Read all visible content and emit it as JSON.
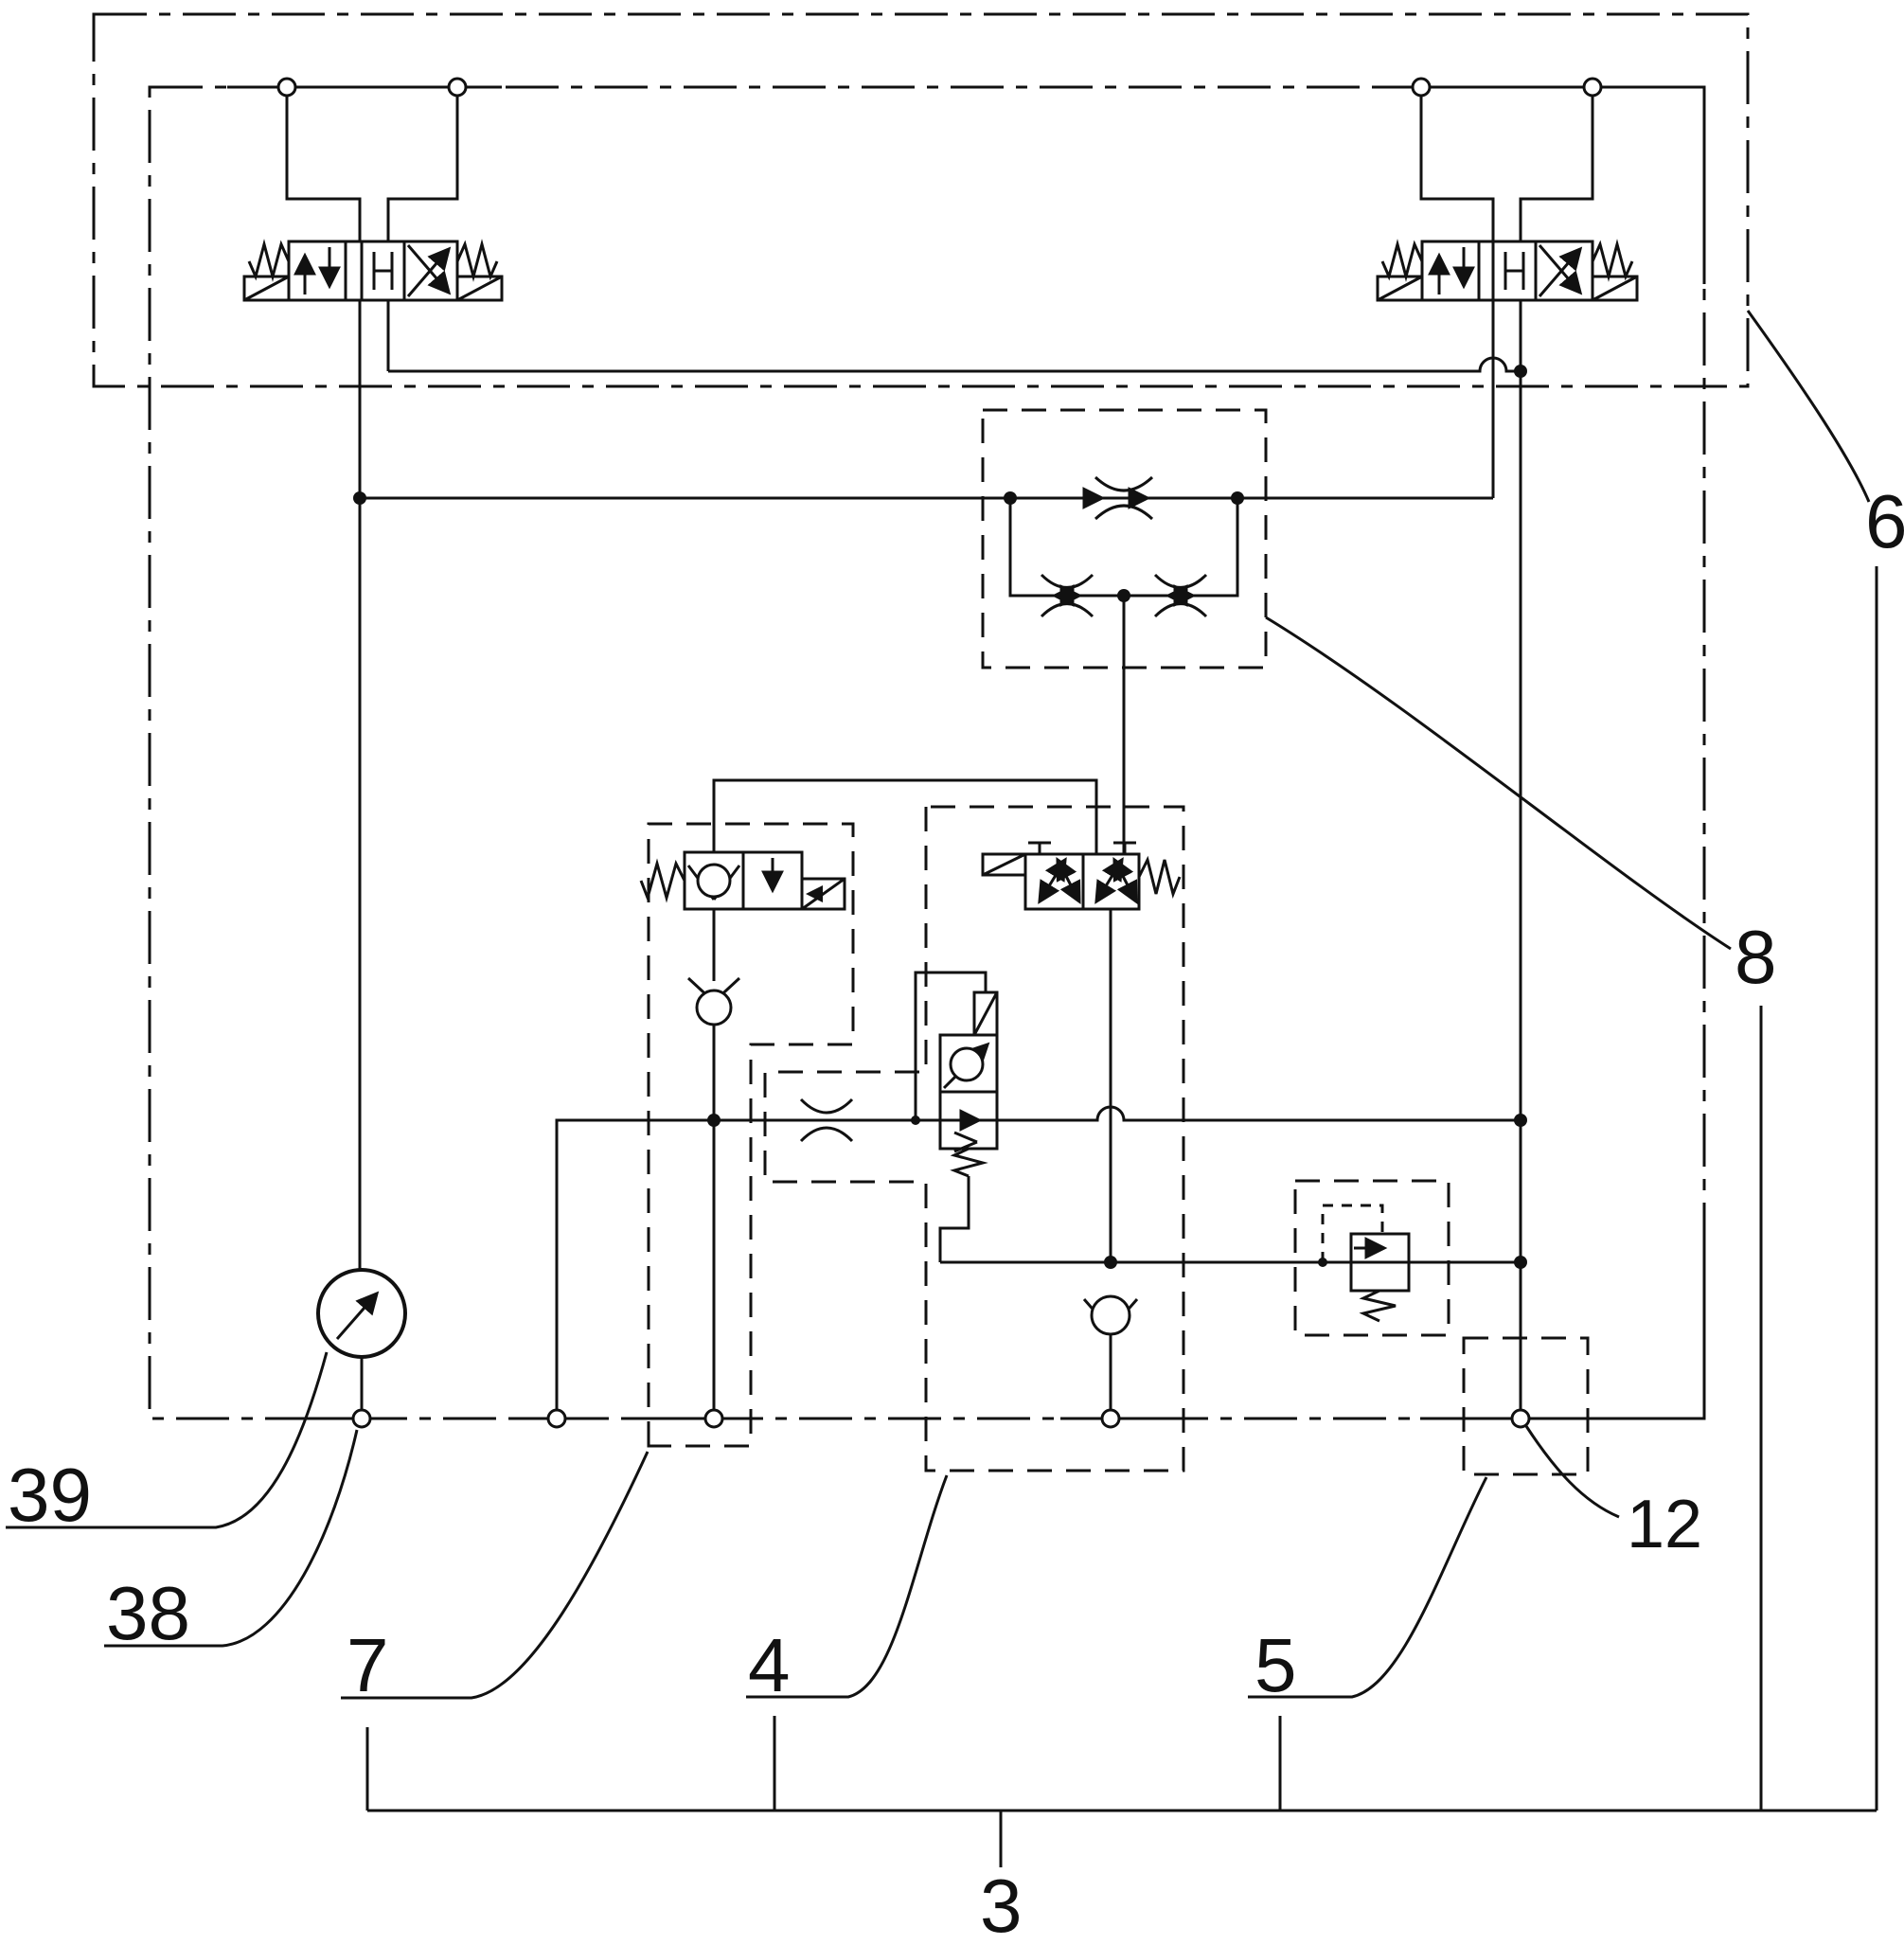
{
  "figure": {
    "type": "hydraulic-circuit-diagram",
    "background_color": "#ffffff",
    "line_color": "#111111",
    "description": "Patent hydraulic schematic: valve manifold with two solenoid directional valves, throttle block, shut-off valve, pressure compensator, relief valve, gauge and numbered reference leaders"
  },
  "labels": {
    "l39": {
      "text": "39"
    },
    "l38": {
      "text": "38"
    },
    "l7": {
      "text": "7"
    },
    "l4": {
      "text": "4"
    },
    "l5": {
      "text": "5"
    },
    "l3": {
      "text": "3"
    },
    "l12": {
      "text": "12"
    },
    "l8": {
      "text": "8"
    },
    "l6": {
      "text": "6"
    }
  },
  "components": [
    "valve-assembly-enclosure-6",
    "manifold-enclosure-3",
    "directional-valve-4-3-left",
    "directional-valve-4-3-right",
    "throttle-flow-block-8",
    "shutoff-seat-valve-block-7",
    "check-valve-left",
    "pressure-compensator-valve",
    "metering-block-4",
    "three-two-pilot-valve",
    "check-valve-right",
    "pressure-relief-valve",
    "outlet-port-block-12",
    "pressure-gauge-39",
    "gauge-port-38",
    "group-bracket-3"
  ]
}
